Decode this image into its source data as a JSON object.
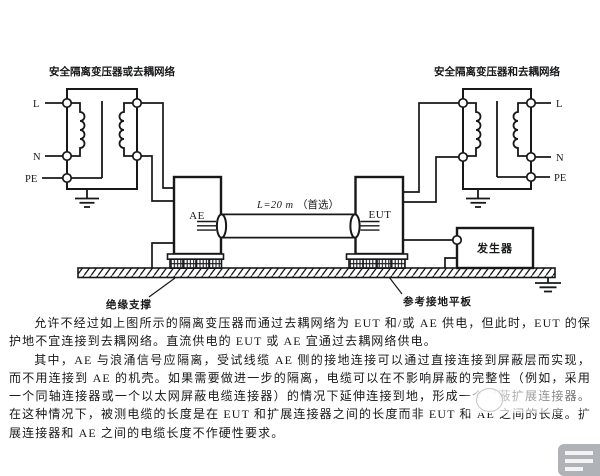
{
  "figure": {
    "left_transformer": {
      "title": "安全隔离变压器或去耦网络"
    },
    "right_transformer": {
      "title": "安全隔离变压器和去耦网络"
    },
    "terminals": {
      "live": "L",
      "neutral": "N",
      "protective_earth": "PE"
    },
    "boxes": {
      "ae": "AE",
      "eut": "EUT",
      "generator": "发生器"
    },
    "cable": {
      "length_label": "L=20 m",
      "length_note": "（首选）"
    },
    "callouts": {
      "insulation_support": "绝缘支撑",
      "reference_ground_plane": "参考接地平板"
    }
  },
  "body": {
    "paragraph1": "允许不经过如上图所示的隔离变压器而通过去耦网络为 EUT 和/或 AE 供电，但此时，EUT 的保护地不宜连接到去耦网络。直流供电的 EUT 或 AE 宜通过去耦网络供电。",
    "paragraph2": "其中，AE 与浪涌信号应隔离，受试线缆 AE 侧的接地连接可以通过直接连接到屏蔽层而实现，而不用连接到 AE 的机壳。如果需要做进一步的隔离，电缆可以在不影响屏蔽的完整性（例如，采用一个同轴连接器或一个以太网屏蔽电缆连接器）的情况下延伸连接到地，形成一个屏蔽扩展连接器。在这种情况下，被测电缆的长度是在 EUT 和扩展连接器之间的长度而非 EUT 和 AE 之间的长度。扩展连接器和 AE 之间的电缆长度不作硬性要求。"
  },
  "colors": {
    "ink": "#17181a",
    "background": "#ffffff"
  }
}
